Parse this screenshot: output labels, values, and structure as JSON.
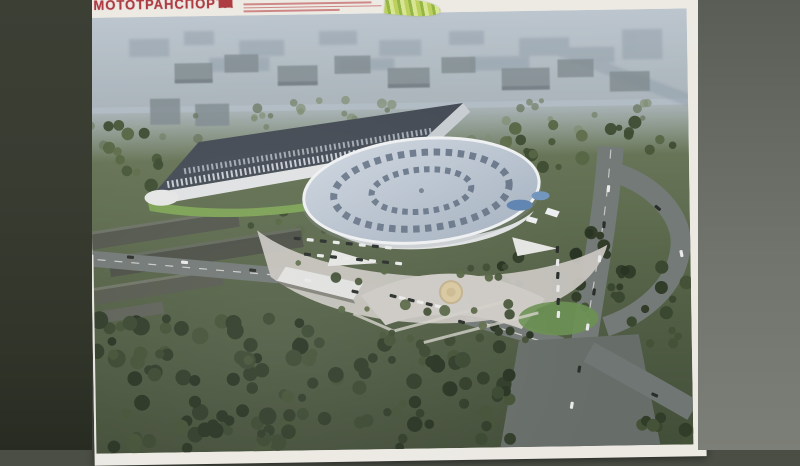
{
  "alt_text": "Photograph of a printed page: aerial architectural rendering of an oval velodrome arena complex with a wedge-shaped annex building, surrounding roads with cars, parking lots, plazas, a fountain and dense trees",
  "header": {
    "headline_partial": "МОТОТРАНСПОРТА"
  },
  "icons": {
    "leaf": "leaf-logo-icon"
  },
  "colors": {
    "banner_red": "#a93138",
    "paper": "#ece9e3",
    "bg_left": "#363a2f",
    "bg_right": "#6e726b",
    "road": "#707673",
    "plaza": "#c7c4be",
    "ground": "#5c6b4b",
    "forest": "#2e3a25",
    "arena_roof": "#b9c4d3",
    "arena_ring": "#5c6b80",
    "wedge_roof": "#424953",
    "facade_white": "#dfe1e2",
    "pond_blue": "#5b83b5",
    "fountain_tan": "#d9c79b"
  }
}
